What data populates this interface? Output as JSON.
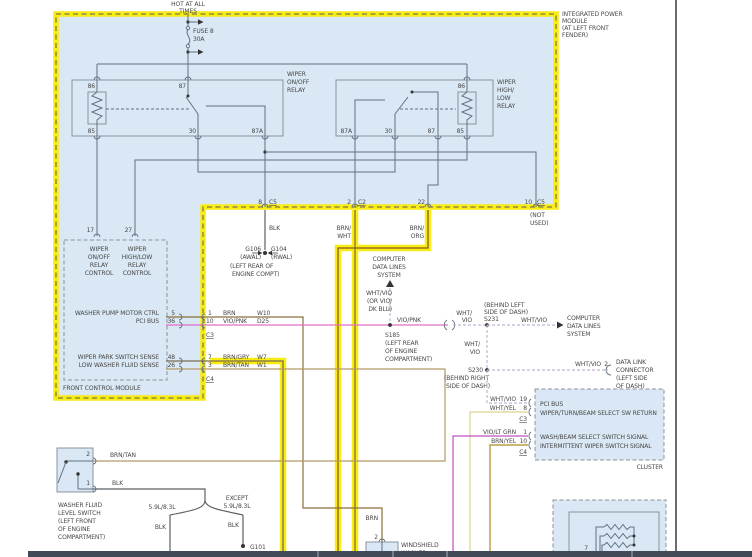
{
  "colors": {
    "highlight_yellow": "#f8ec12",
    "module_fill_blue": "#d9e8f4",
    "wire_brn": "#8a6d3b",
    "wire_brn_org": "#8a5a28",
    "wire_vio_pnk": "#e06ec8",
    "wire_brn_tan": "#b59a68",
    "wire_brn_gry": "#7d6a52",
    "wire_wht_vio": "#c4b2d4",
    "wire_wht_yel": "#ddd48e",
    "wire_vio_lt_grn": "#c24fc2",
    "wire_brn_yel": "#ab8d1f",
    "wire_blk": "#5c6166"
  },
  "power": {
    "hot_line1": "HOT AT ALL",
    "hot_line2": "TIMES",
    "fuse_name": "FUSE 8",
    "fuse_rating": "30A"
  },
  "ipm": {
    "name_line1": "INTEGRATED POWER",
    "name_line2": "MODULE",
    "name_line3": "(AT LEFT FRONT",
    "name_line4": "FENDER)"
  },
  "relay_onoff": {
    "label_line1": "WIPER",
    "label_line2": "ON/OFF",
    "label_line3": "RELAY",
    "pin_86": "86",
    "pin_87": "87",
    "pin_85": "85",
    "pin_30": "30",
    "pin_87a": "87A"
  },
  "relay_highlow": {
    "label_line1": "WIPER",
    "label_line2": "HIGH/",
    "label_line3": "LOW",
    "label_line4": "RELAY",
    "pin_86": "86",
    "pin_85": "85",
    "pin_87a": "87A",
    "pin_30": "30",
    "pin_87": "87"
  },
  "ipm_outputs": {
    "pin8": "8",
    "conn8": "C5",
    "wire8": "BLK",
    "pin2": "2",
    "conn2": "C2",
    "wire2_line1": "BRN/",
    "wire2_line2": "WHT",
    "pin22": "22",
    "wire22_line1": "BRN/",
    "wire22_line2": "ORG",
    "pin10": "10",
    "conn10": "C5",
    "not_used_line1": "(NOT",
    "not_used_line2": "USED)"
  },
  "ground_engine": {
    "id_left": "G106",
    "loc_left": "(AWAL)",
    "id_right": "G104",
    "loc_right": "(RWAL)",
    "loc_line1": "(LEFT REAR OF",
    "loc_line2": "ENGINE COMPT)"
  },
  "fcm": {
    "pin17": "17",
    "pin27": "27",
    "onoff_line1": "WIPER",
    "onoff_line2": "ON/OFF",
    "onoff_line3": "RELAY",
    "onoff_line4": "CONTROL",
    "highlow_line1": "WIPER",
    "highlow_line2": "HIGH/LOW",
    "highlow_line3": "RELAY",
    "highlow_line4": "CONTROL",
    "rows": [
      {
        "label": "WASHER PUMP MOTOR CTRL",
        "pin": "5",
        "conn_pin": "1",
        "wire": "BRN",
        "circuit": "W10"
      },
      {
        "label": "PCI BUS",
        "pin": "36",
        "conn_pin": "10",
        "wire": "VIO/PNK",
        "circuit": "D25"
      },
      {
        "label": "WIPER PARK SWITCH SENSE",
        "pin": "48",
        "conn_pin": "7",
        "wire": "BRN/GRY",
        "circuit": "W7"
      },
      {
        "label": "LOW WASHER FLUID SENSE",
        "pin": "26",
        "conn_pin": "3",
        "wire": "BRN/TAN",
        "circuit": "W1"
      }
    ],
    "conn_c3": "C3",
    "conn_c4": "C4",
    "name": "FRONT CONTROL MODULE"
  },
  "data_lines_engine": {
    "sys_line1": "COMPUTER",
    "sys_line2": "DATA LINES",
    "sys_line3": "SYSTEM",
    "wire_line1": "WHT/VIO",
    "wire_line2": "(OR VIO/",
    "wire_line3": "DK BLU)",
    "wire_vio_pnk": "VIO/PNK",
    "splice": "S185",
    "loc_line1": "(LEFT REAR",
    "loc_line2": "OF ENGINE",
    "loc_line3": "COMPARTMENT)"
  },
  "splice_s231": {
    "wire_line1": "WHT/",
    "wire_line2": "VIO",
    "loc_line1": "(BEHIND LEFT",
    "loc_line2": "SIDE OF DASH)",
    "id": "S231",
    "wire_right": "WHT/VIO",
    "sys_line1": "COMPUTER",
    "sys_line2": "DATA LINES",
    "sys_line3": "SYSTEM"
  },
  "splice_s230": {
    "wire_line1": "WHT/",
    "wire_line2": "VIO",
    "id": "S230",
    "loc_line1": "(BEHIND RIGHT",
    "loc_line2": "SIDE OF DASH)"
  },
  "dlc": {
    "wire": "WHT/VIO",
    "pin": "2",
    "name_line1": "DATA LINK",
    "name_line2": "CONNECTOR",
    "name_line3": "(LEFT SIDE",
    "name_line4": "OF DASH)"
  },
  "cluster": {
    "rows": [
      {
        "wire": "WHT/VIO",
        "pin": "19",
        "label": "PCI BUS"
      },
      {
        "wire": "WHT/YEL",
        "pin": "8",
        "label": "WIPER/TURN/BEAM SELECT SW RETURN"
      },
      {
        "wire": "VIO/LT GRN",
        "pin": "1",
        "label": "WASH/BEAM SELECT SWITCH SIGNAL"
      },
      {
        "wire": "BRN/YEL",
        "pin": "10",
        "label": "INTERMITTENT WIPER SWITCH SIGNAL"
      }
    ],
    "conn_c3": "C3",
    "conn_c4": "C4",
    "name": "CLUSTER"
  },
  "washer_switch": {
    "pin2": "2",
    "wire2": "BRN/TAN",
    "pin1": "1",
    "wire1": "BLK",
    "name_line1": "WASHER FLUID",
    "name_line2": "LEVEL SWITCH",
    "name_line3": "(LEFT FRONT",
    "name_line4": "OF ENGINE",
    "name_line5": "COMPARTMENT)"
  },
  "ground_split": {
    "branch_left": "5.9L/8.3L",
    "branch_right_line1": "EXCEPT",
    "branch_right_line2": "5.9L/8.3L",
    "wire_left": "BLK",
    "wire_right": "BLK",
    "ground_id": "G101"
  },
  "washer_pump": {
    "wire": "BRN",
    "pin": "2",
    "name_line1": "WINDSHIELD",
    "name_line2": "WASHER"
  },
  "wiper_switch": {
    "pin7": "7"
  }
}
